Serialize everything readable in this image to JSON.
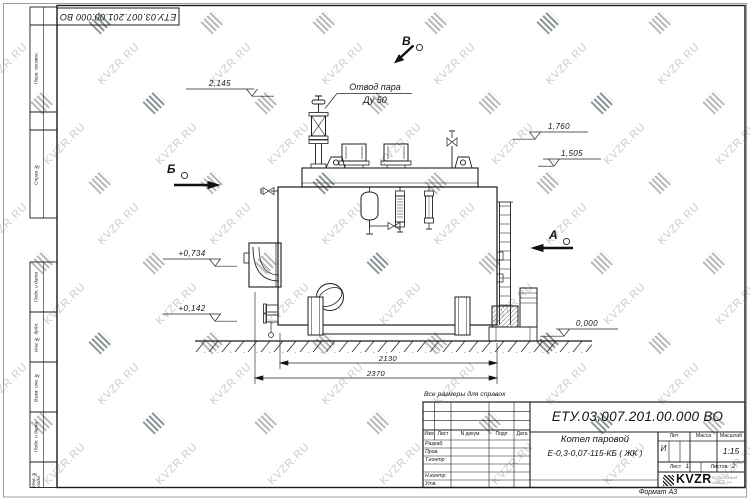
{
  "watermark": {
    "text": "KVZR.RU"
  },
  "sheet": {
    "format_label": "Формат А3",
    "reference_note": "Все размеры для справок",
    "top_designation": "ЕТУ.03.007.201.00.000  ВО"
  },
  "frame": {
    "side_top": [
      "Перв. примен.",
      "Справ. №"
    ],
    "side_bottom": [
      "Подп. и дата",
      "Инв. № дубл.",
      "Взам. инв. №",
      "Подп. и дата",
      "Инв. № подл."
    ]
  },
  "drawing": {
    "callout_line1": "Отвод пара",
    "callout_line2": "Ду 50",
    "views": {
      "b": "Б",
      "v": "В",
      "a": "А"
    },
    "levels": [
      {
        "value": "2,145"
      },
      {
        "value": "1,760"
      },
      {
        "value": "1,505"
      },
      {
        "value": "+0,734"
      },
      {
        "value": "+0,142"
      },
      {
        "value": "0,000"
      }
    ],
    "dimensions": [
      {
        "value": "2130"
      },
      {
        "value": "2370"
      }
    ]
  },
  "title_block": {
    "designation": "ЕТУ.03.007.201.00.000  ВО",
    "product_name_line1": "Котел паровой",
    "product_name_line2": "Е-0,3-0,07-115-КБ ( ЖК )",
    "change_header": {
      "izm": "Изм",
      "list": "Лист",
      "doc": "N докум",
      "sign": "Подп",
      "date": "Дата"
    },
    "role_rows": [
      "Разраб.",
      "Пров.",
      "Т.контр",
      "",
      "Н.контр",
      "Утв."
    ],
    "lit_label": "Лит",
    "mass_label": "Масса",
    "scale_label": "Масштаб",
    "lit_value": "И",
    "scale_value": "1:15",
    "sheet_label": "Лист",
    "sheet_number": "1",
    "sheets_label": "Листов",
    "sheets_total": "2",
    "logo_text": "KVZR",
    "logo_caption_line1": "КОТЕЛЬНЫЙ",
    "logo_caption_line2": "ЗАВОД.РУ"
  }
}
